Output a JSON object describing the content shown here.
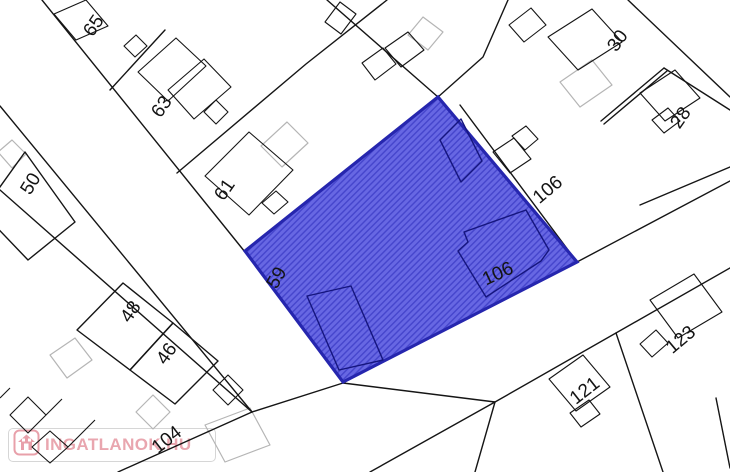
{
  "map": {
    "description": "cadastral parcel map with highlighted lot",
    "highlight_fill": "#6767e3",
    "highlight_hatch": "#4646cd",
    "highlight_border": "#2626ae",
    "parcel_line_color": "#151515",
    "gray_building_color": "#b5b5b5",
    "parcel_labels": [
      {
        "text": "65",
        "x": 94,
        "y": 26,
        "rot": -55
      },
      {
        "text": "63",
        "x": 162,
        "y": 107,
        "rot": -55
      },
      {
        "text": "61",
        "x": 225,
        "y": 190,
        "rot": -55
      },
      {
        "text": "50",
        "x": 31,
        "y": 184,
        "rot": -58
      },
      {
        "text": "48",
        "x": 131,
        "y": 312,
        "rot": -55
      },
      {
        "text": "46",
        "x": 167,
        "y": 354,
        "rot": -55
      },
      {
        "text": "59",
        "x": 277,
        "y": 278,
        "rot": -60
      },
      {
        "text": "106",
        "x": 498,
        "y": 274,
        "rot": -25
      },
      {
        "text": "106",
        "x": 548,
        "y": 190,
        "rot": -40
      },
      {
        "text": "30",
        "x": 618,
        "y": 41,
        "rot": -55
      },
      {
        "text": "28",
        "x": 681,
        "y": 118,
        "rot": -55
      },
      {
        "text": "121",
        "x": 585,
        "y": 391,
        "rot": -38
      },
      {
        "text": "123",
        "x": 681,
        "y": 340,
        "rot": -40
      },
      {
        "text": "104",
        "x": 167,
        "y": 440,
        "rot": -38
      }
    ]
  },
  "logo": {
    "text": "INGATLANOK.HU",
    "text_color": "#e9a6af",
    "box_border_color": "#d6d6d6"
  }
}
